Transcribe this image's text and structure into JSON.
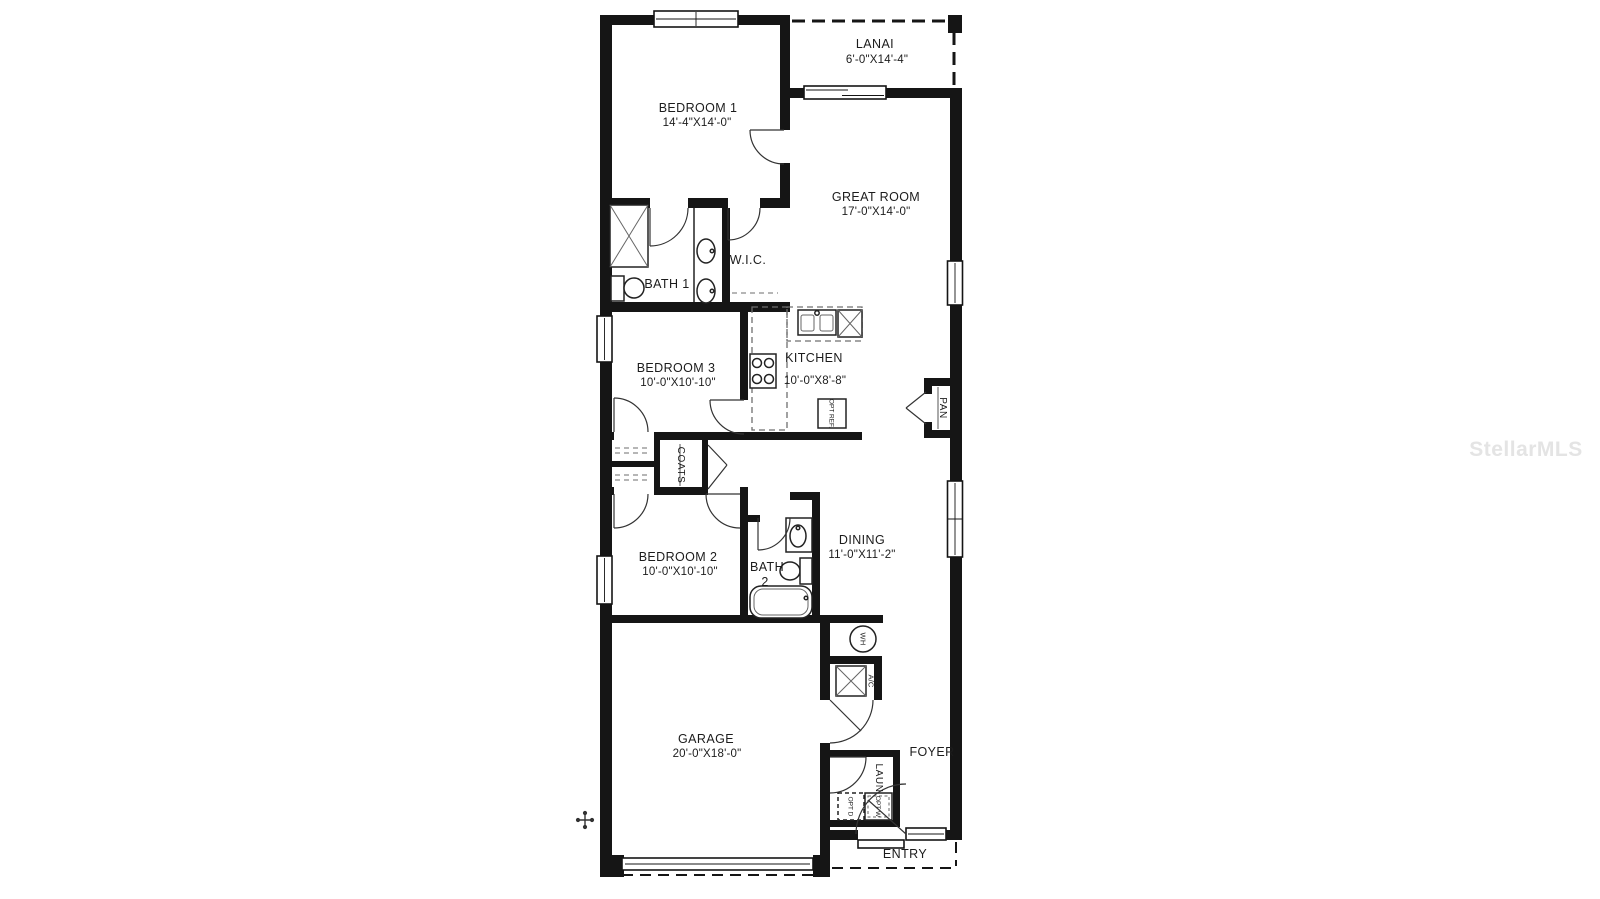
{
  "watermark": "StellarMLS",
  "rooms": {
    "lanai": {
      "name": "LANAI",
      "dims": "6'-0\"X14'-4\""
    },
    "bedroom1": {
      "name": "BEDROOM 1",
      "dims": "14'-4\"X14'-0\""
    },
    "great_room": {
      "name": "GREAT ROOM",
      "dims": "17'-0\"X14'-0\""
    },
    "bath1": {
      "name": "BATH 1"
    },
    "wic": {
      "name": "W.I.C."
    },
    "kitchen": {
      "name": "KITCHEN",
      "dims": "10'-0\"X8'-8\""
    },
    "bedroom3": {
      "name": "BEDROOM 3",
      "dims": "10'-0\"X10'-10\""
    },
    "bedroom2": {
      "name": "BEDROOM 2",
      "dims": "10'-0\"X10'-10\""
    },
    "bath2": {
      "name": "BATH",
      "number": "2"
    },
    "dining": {
      "name": "DINING",
      "dims": "11'-0\"X11'-2\""
    },
    "garage": {
      "name": "GARAGE",
      "dims": "20'-0\"X18'-0\""
    },
    "foyer": {
      "name": "FOYER"
    },
    "entry": {
      "name": "ENTRY"
    }
  },
  "closets": {
    "coats": "COATS",
    "pantry": "PAN",
    "laundry": "LAUN"
  },
  "equipment": {
    "water_heater": "WH",
    "ac_unit": "A/C",
    "opt_refrigerator": "OPT REF.",
    "opt_dryer": "OPT D",
    "opt_washer": "OPT W"
  },
  "colors": {
    "walls": "#151515",
    "text": "#1c1c1c",
    "watermark": "#e4e4e4"
  }
}
